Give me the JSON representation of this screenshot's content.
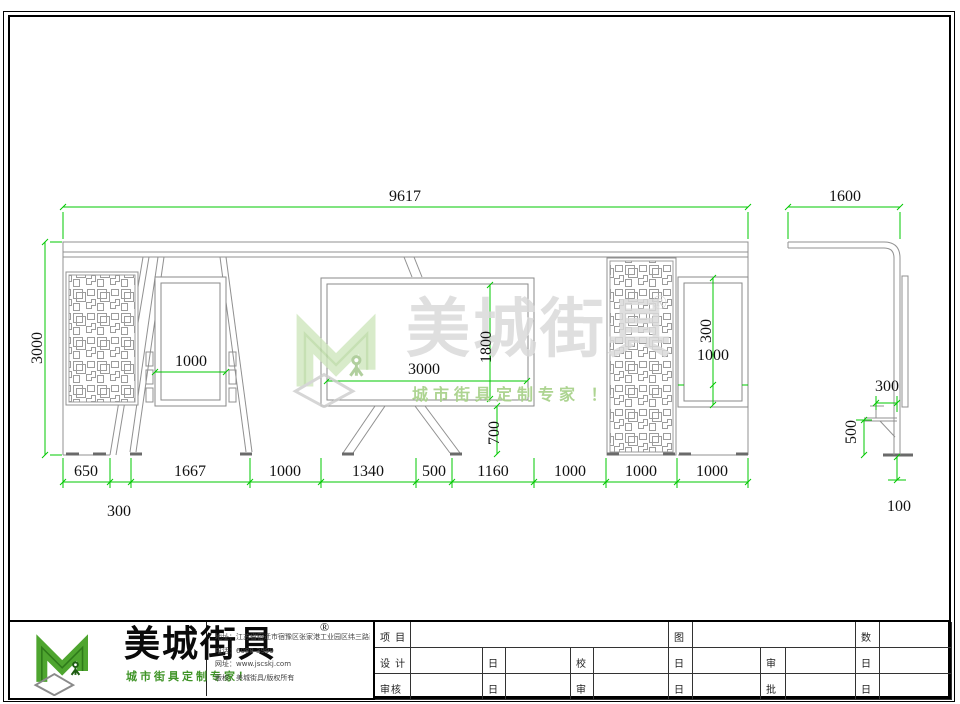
{
  "front_view": {
    "overall_width": "9617",
    "overall_height": "3000",
    "left_sign_width": "1000",
    "panel_width": "3000",
    "panel_height": "1800",
    "panel_ground_clearance": "700",
    "right_sign_height": "300",
    "right_sign_width": "1000",
    "bottom_dims": [
      "650",
      "1667",
      "1000",
      "1340",
      "500",
      "1160",
      "1000",
      "1000",
      "1000"
    ],
    "bottom_sub_dim": "300"
  },
  "side_view": {
    "overall_depth": "1600",
    "seat_depth": "300",
    "seat_height": "500",
    "base_offset": "100"
  },
  "watermark": {
    "brand": "美城街具",
    "registered_mark": "®",
    "slogan": "城市街具定制专家 ！"
  },
  "logo_block": {
    "brand": "美城街具",
    "registered_mark": "®",
    "slogan": "城市街具定制专家！",
    "address_line": "地址：江苏省宿迁市宿豫区张家港工业园区纬三路西侧1号",
    "phone_line": "电话：6088 3999",
    "website_line": "网址：www.jscskj.com",
    "copyright_line": "版权：美城街具/版权所有"
  },
  "title_block": {
    "project_label": "项 目",
    "drawing_name_label": "图 名",
    "quantity_label": "数 量",
    "design_label": "设 计",
    "date_label": "日 期",
    "proofread_label": "校对",
    "reviewer1_label": "审核一",
    "reviewer2_label": "审核二",
    "approve_check_label": "审定",
    "approve_label": "批准"
  },
  "colors": {
    "dimension_green": "#00c800",
    "line_gray": "#909090",
    "brand_green": "#4ea52f",
    "watermark_gray": "#dadada",
    "watermark_green": "#a9d28c"
  }
}
